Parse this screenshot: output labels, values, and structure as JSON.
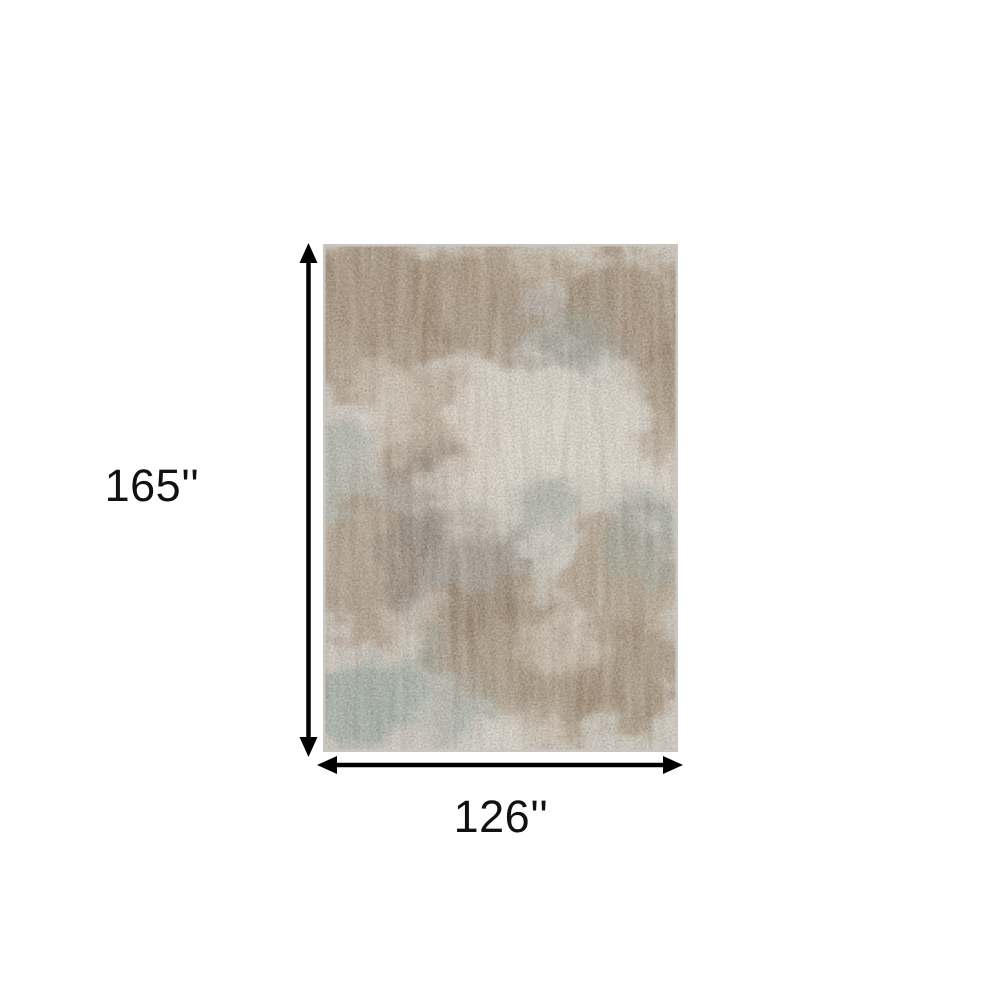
{
  "page": {
    "background_color": "#ffffff"
  },
  "diagram": {
    "type": "product-dimension-diagram",
    "height_label": "165''",
    "width_label": "126''",
    "label_color": "#111111",
    "arrow_color": "#000000",
    "rug": {
      "description": "Distressed abstract area rug in gray, taupe, brown and muted teal",
      "palette": {
        "base": "#d3cfc8",
        "ivory": "#e7e3db",
        "brown": "#8c7258",
        "taupe": "#a18a72",
        "dark_gray": "#6f6761",
        "teal": "#8ba29e",
        "edge": "#c9c6c1"
      }
    }
  }
}
